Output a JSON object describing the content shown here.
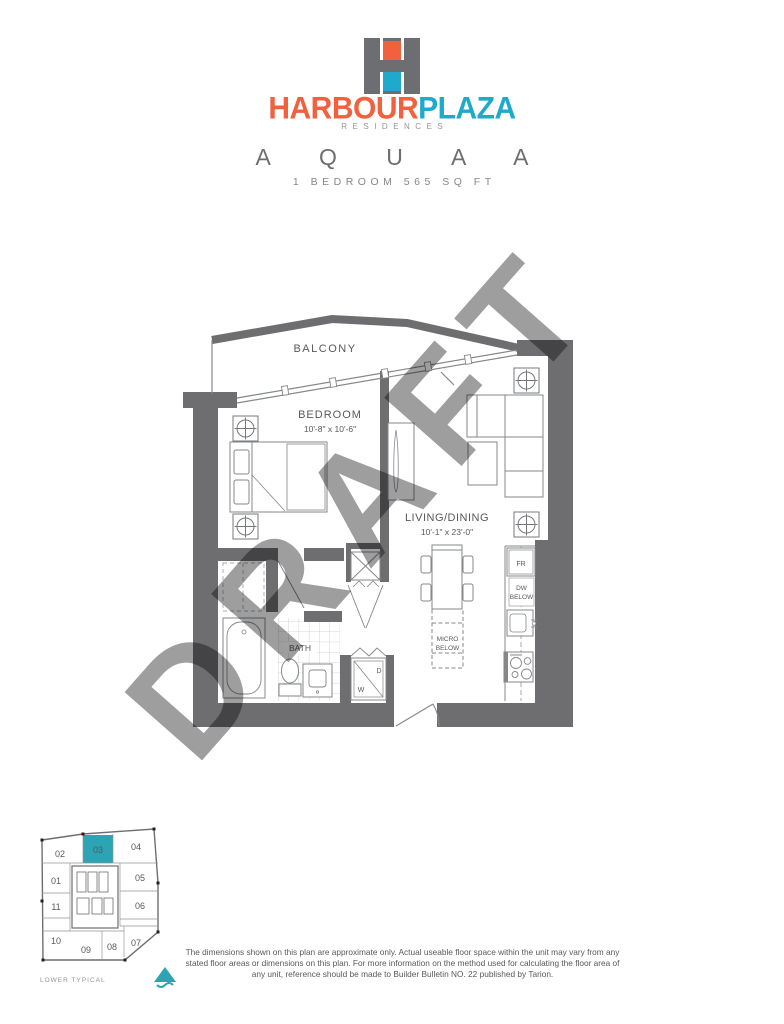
{
  "logo": {
    "brand_primary": "HARBOUR",
    "brand_secondary": "PLAZA",
    "subtitle": "RESIDENCES",
    "colors": {
      "orange": "#F1603F",
      "teal": "#1FA9CB",
      "gray": "#6D6E71"
    }
  },
  "plan": {
    "title": "A Q U A   A",
    "spec": "1 BEDROOM 565 SQ FT"
  },
  "watermark": "DRAFT",
  "floorplan": {
    "wall_color": "#6E6E70",
    "labels": {
      "balcony": "BALCONY",
      "bedroom": "BEDROOM",
      "bedroom_dims": "10'-8\" x 10'-6\"",
      "living": "LIVING/DINING",
      "living_dims": "10'-1\" x 23'-0\"",
      "bath": "BATH",
      "fridge": "FR",
      "dw_line1": "DW",
      "dw_line2": "BELOW",
      "micro_line1": "MICRO",
      "micro_line2": "BELOW",
      "washer": "W",
      "dryer": "D"
    }
  },
  "keyplan": {
    "caption": "LOWER TYPICAL",
    "highlight_unit": "03",
    "highlight_color": "#2BA4B4",
    "units": {
      "u01": "01",
      "u02": "02",
      "u03": "03",
      "u04": "04",
      "u05": "05",
      "u06": "06",
      "u07": "07",
      "u08": "08",
      "u09": "09",
      "u10": "10",
      "u11": "11"
    }
  },
  "disclaimer": {
    "text": "The dimensions shown on this plan are approximate only. Actual useable floor space within the unit may vary from any stated floor areas or dimensions on this plan. For more information on the method used for calculating the floor area of any unit, reference should be made to Builder Bulletin NO. 22 published by Tarion."
  }
}
